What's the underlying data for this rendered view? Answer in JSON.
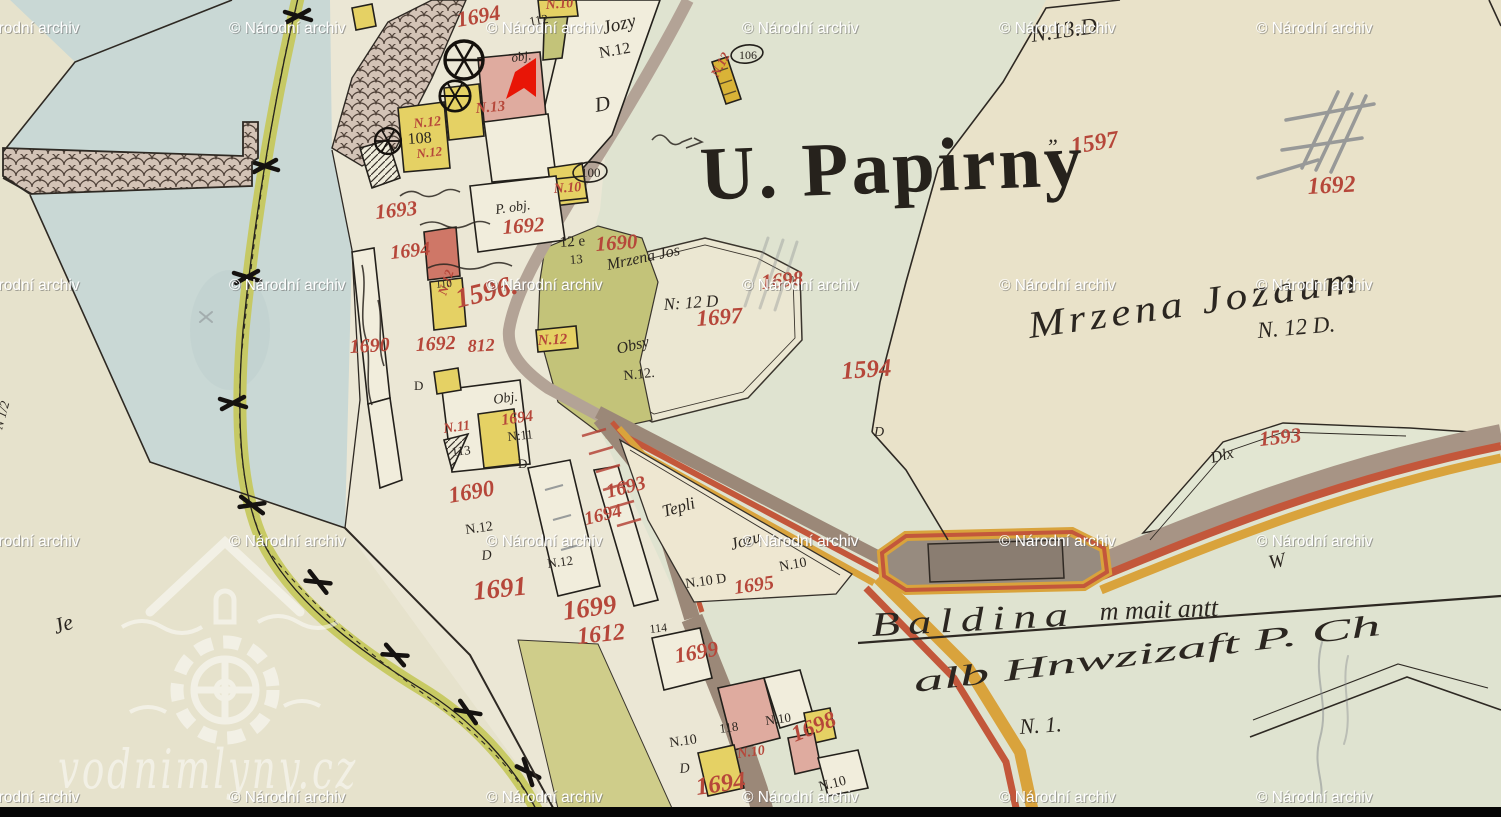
{
  "title": {
    "text": "U. Papirny"
  },
  "watermark": {
    "label": "© Národní archiv",
    "rows": [
      33,
      290,
      546,
      802
    ],
    "cols": [
      -37,
      229,
      486,
      742,
      999,
      1256
    ]
  },
  "site_watermark": {
    "text": "vodnimlyny.cz"
  },
  "marker": {
    "name": "red-arrow-marker",
    "color": "#e81506"
  },
  "colors": {
    "paper_green": "#dfe3d0",
    "paper_beige": "#e9e2c9",
    "water": "#c9d8d5",
    "building_yellow": "#e5d164",
    "building_pink": "#dfab9f",
    "building_red": "#cf7767",
    "building_white": "#f1eddc",
    "garden_olive": "#c3c379",
    "canal_green": "#c6c85e",
    "road_gray": "#9b8878",
    "road_red": "#c3573b",
    "road_ochre": "#d9a33c",
    "label_red": "#b6473a",
    "ink": "#2b2620",
    "pencil": "#84888c"
  },
  "labels": {
    "red": [
      {
        "t": "1694",
        "x": 458,
        "y": 27,
        "s": 22,
        "r": -10
      },
      {
        "t": "1597",
        "x": 1072,
        "y": 154,
        "s": 24,
        "r": -9
      },
      {
        "t": "1692",
        "x": 1308,
        "y": 194,
        "s": 24,
        "r": -3
      },
      {
        "t": "1693",
        "x": 376,
        "y": 219,
        "s": 21,
        "r": -6
      },
      {
        "t": "1694",
        "x": 391,
        "y": 259,
        "s": 20,
        "r": -6
      },
      {
        "t": "1692",
        "x": 503,
        "y": 234,
        "s": 21,
        "r": -4
      },
      {
        "t": "1690",
        "x": 596,
        "y": 251,
        "s": 21,
        "r": -4
      },
      {
        "t": "1596.",
        "x": 458,
        "y": 308,
        "s": 28,
        "r": -14
      },
      {
        "t": "1698",
        "x": 762,
        "y": 289,
        "s": 21,
        "r": -6
      },
      {
        "t": "1697",
        "x": 697,
        "y": 326,
        "s": 23,
        "r": -4
      },
      {
        "t": "1594",
        "x": 842,
        "y": 379,
        "s": 25,
        "r": -4
      },
      {
        "t": "1593",
        "x": 1260,
        "y": 446,
        "s": 21,
        "r": -6
      },
      {
        "t": "1690",
        "x": 350,
        "y": 353,
        "s": 20,
        "r": -3
      },
      {
        "t": "1692",
        "x": 416,
        "y": 351,
        "s": 20,
        "r": -3
      },
      {
        "t": "812",
        "x": 468,
        "y": 352,
        "s": 18,
        "r": -3
      },
      {
        "t": "N.12",
        "x": 538,
        "y": 345,
        "s": 15,
        "r": -3
      },
      {
        "t": "N.12",
        "x": 414,
        "y": 128,
        "s": 14,
        "r": -6
      },
      {
        "t": "N.12",
        "x": 417,
        "y": 158,
        "s": 13,
        "r": -6
      },
      {
        "t": "N.13",
        "x": 476,
        "y": 113,
        "s": 15,
        "r": -5
      },
      {
        "t": "N.10",
        "x": 554,
        "y": 193,
        "s": 14,
        "r": -4
      },
      {
        "t": "N.10",
        "x": 546,
        "y": 9,
        "s": 14,
        "r": -4
      },
      {
        "t": "N.12",
        "x": 718,
        "y": 78,
        "s": 13,
        "r": -62
      },
      {
        "t": "N.12",
        "x": 446,
        "y": 296,
        "s": 13,
        "r": -72
      },
      {
        "t": "1690",
        "x": 450,
        "y": 503,
        "s": 23,
        "r": -10
      },
      {
        "t": "N.11",
        "x": 444,
        "y": 433,
        "s": 14,
        "r": -8
      },
      {
        "t": "1694",
        "x": 502,
        "y": 425,
        "s": 16,
        "r": -8
      },
      {
        "t": "1691",
        "x": 474,
        "y": 600,
        "s": 27,
        "r": -6
      },
      {
        "t": "1699",
        "x": 564,
        "y": 620,
        "s": 27,
        "r": -8
      },
      {
        "t": "1612",
        "x": 578,
        "y": 644,
        "s": 24,
        "r": -6
      },
      {
        "t": "1693",
        "x": 608,
        "y": 498,
        "s": 20,
        "r": -14
      },
      {
        "t": "1694",
        "x": 586,
        "y": 525,
        "s": 19,
        "r": -14
      },
      {
        "t": "1695",
        "x": 735,
        "y": 594,
        "s": 20,
        "r": -8
      },
      {
        "t": "1699",
        "x": 676,
        "y": 663,
        "s": 22,
        "r": -10
      },
      {
        "t": "1698",
        "x": 795,
        "y": 742,
        "s": 23,
        "r": -22
      },
      {
        "t": "N.10",
        "x": 738,
        "y": 758,
        "s": 14,
        "r": -8
      },
      {
        "t": "1694",
        "x": 697,
        "y": 795,
        "s": 25,
        "r": -8
      }
    ],
    "black": [
      {
        "t": "N.13.D",
        "x": 1032,
        "y": 42,
        "s": 23,
        "r": -8,
        "script": 1
      },
      {
        "t": "Jozy",
        "x": 604,
        "y": 34,
        "s": 19,
        "r": -14,
        "script": 1
      },
      {
        "t": "N.12",
        "x": 600,
        "y": 58,
        "s": 16,
        "r": -10
      },
      {
        "t": "D",
        "x": 596,
        "y": 112,
        "s": 21,
        "r": -10,
        "script": 1
      },
      {
        "t": "112",
        "x": 530,
        "y": 26,
        "s": 13,
        "r": -10
      },
      {
        "t": "obj.",
        "x": 512,
        "y": 62,
        "s": 13,
        "r": -8,
        "script": 1
      },
      {
        "t": "108",
        "x": 408,
        "y": 144,
        "s": 16,
        "r": -4
      },
      {
        "t": "P. obj.",
        "x": 496,
        "y": 214,
        "s": 14,
        "r": -8,
        "script": 1
      },
      {
        "t": "12 e",
        "x": 560,
        "y": 247,
        "s": 15,
        "r": -4
      },
      {
        "t": "13",
        "x": 570,
        "y": 264,
        "s": 13,
        "r": -4
      },
      {
        "t": "Mrzena Jos",
        "x": 608,
        "y": 270,
        "s": 16,
        "r": -12,
        "script": 1
      },
      {
        "t": "N: 12 D",
        "x": 664,
        "y": 310,
        "s": 17,
        "r": -4,
        "script": 1
      },
      {
        "t": "Obsy",
        "x": 618,
        "y": 354,
        "s": 16,
        "r": -14,
        "script": 1
      },
      {
        "t": "N.12.",
        "x": 624,
        "y": 380,
        "s": 14,
        "r": -6
      },
      {
        "t": "Obj.",
        "x": 494,
        "y": 404,
        "s": 14,
        "r": -8,
        "script": 1
      },
      {
        "t": "N:11",
        "x": 508,
        "y": 441,
        "s": 13,
        "r": -6
      },
      {
        "t": "113",
        "x": 452,
        "y": 456,
        "s": 13,
        "r": -6
      },
      {
        "t": "D",
        "x": 518,
        "y": 468,
        "s": 13,
        "r": 0
      },
      {
        "t": "110",
        "x": 436,
        "y": 288,
        "s": 11,
        "r": -4
      },
      {
        "t": "N.12",
        "x": 466,
        "y": 534,
        "s": 14,
        "r": -8
      },
      {
        "t": "D",
        "x": 482,
        "y": 560,
        "s": 14,
        "r": -6,
        "script": 1
      },
      {
        "t": "N.12",
        "x": 548,
        "y": 568,
        "s": 13,
        "r": -8
      },
      {
        "t": "D",
        "x": 414,
        "y": 390,
        "s": 13,
        "r": 0
      },
      {
        "t": "Mrzena Jozaum",
        "x": 1030,
        "y": 338,
        "s": 38,
        "r": -8,
        "script": 1,
        "w": 335,
        "ls": 4
      },
      {
        "t": "N. 12 D.",
        "x": 1258,
        "y": 338,
        "s": 23,
        "r": -5,
        "script": 1
      },
      {
        "t": "„",
        "x": 1048,
        "y": 142,
        "s": 22,
        "r": 0,
        "script": 1
      },
      {
        "t": "Dlx",
        "x": 1212,
        "y": 463,
        "s": 16,
        "r": -14,
        "script": 1
      },
      {
        "t": "W",
        "x": 1270,
        "y": 569,
        "s": 20,
        "r": -12,
        "script": 1
      },
      {
        "t": "Baldina",
        "x": 872,
        "y": 636,
        "s": 34,
        "r": -3,
        "script": 1,
        "w": 205,
        "ls": 6
      },
      {
        "t": "m mait antt",
        "x": 1100,
        "y": 620,
        "s": 26,
        "r": -2,
        "script": 1
      },
      {
        "t": "alb Hnwzizaft P. Ch",
        "x": 915,
        "y": 692,
        "s": 30,
        "r": -7,
        "script": 1,
        "w": 470
      },
      {
        "t": "N. 1.",
        "x": 1020,
        "y": 734,
        "s": 22,
        "r": -4,
        "script": 1
      },
      {
        "t": "Tepli",
        "x": 664,
        "y": 517,
        "s": 17,
        "r": -16,
        "script": 1
      },
      {
        "t": "Jozu",
        "x": 732,
        "y": 550,
        "s": 17,
        "r": -16,
        "script": 1
      },
      {
        "t": "N.10",
        "x": 780,
        "y": 571,
        "s": 14,
        "r": -10
      },
      {
        "t": "N.10 D",
        "x": 686,
        "y": 588,
        "s": 14,
        "r": -8
      },
      {
        "t": "114",
        "x": 650,
        "y": 633,
        "s": 12,
        "r": -6
      },
      {
        "t": "118",
        "x": 720,
        "y": 733,
        "s": 13,
        "r": -8
      },
      {
        "t": "N.10",
        "x": 766,
        "y": 725,
        "s": 13,
        "r": -8
      },
      {
        "t": "N.10",
        "x": 670,
        "y": 747,
        "s": 14,
        "r": -8
      },
      {
        "t": "D",
        "x": 680,
        "y": 773,
        "s": 14,
        "r": -6,
        "script": 1
      },
      {
        "t": "N.10",
        "x": 820,
        "y": 791,
        "s": 14,
        "r": -14
      },
      {
        "t": "100",
        "x": 581,
        "y": 177,
        "s": 13,
        "r": 0
      },
      {
        "t": "106",
        "x": 739,
        "y": 59,
        "s": 12,
        "r": 0
      },
      {
        "t": "N 1/2",
        "x": 2,
        "y": 430,
        "s": 13,
        "r": -75,
        "script": 1
      },
      {
        "t": "Je",
        "x": 56,
        "y": 634,
        "s": 22,
        "r": -18,
        "script": 1
      },
      {
        "t": "D",
        "x": 874,
        "y": 436,
        "s": 14,
        "r": 0,
        "script": 1
      }
    ]
  }
}
